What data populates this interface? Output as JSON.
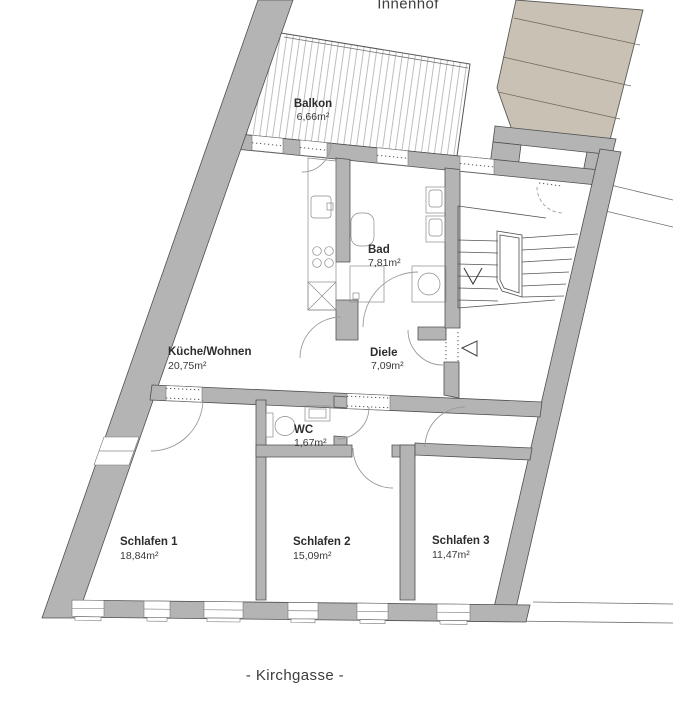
{
  "plan": {
    "outdoor_labels": {
      "top": "Innenhof",
      "bottom": "- Kirchgasse -"
    },
    "rooms": [
      {
        "id": "balkon",
        "name": "Balkon",
        "area": "6,66m²"
      },
      {
        "id": "bad",
        "name": "Bad",
        "area": "7,81m²"
      },
      {
        "id": "kueche",
        "name": "Küche/Wohnen",
        "area": "20,75m²"
      },
      {
        "id": "diele",
        "name": "Diele",
        "area": "7,09m²"
      },
      {
        "id": "wc",
        "name": "WC",
        "area": "1,67m²"
      },
      {
        "id": "schlafen1",
        "name": "Schlafen 1",
        "area": "18,84m²"
      },
      {
        "id": "schlafen2",
        "name": "Schlafen 2",
        "area": "15,09m²"
      },
      {
        "id": "schlafen3",
        "name": "Schlafen 3",
        "area": "11,47m²"
      }
    ],
    "colors": {
      "wall": "#b4b4b4",
      "wall-line": "#4f4f4f",
      "neighbor": "#c9c1b3",
      "text": "#2d2d2d"
    }
  }
}
